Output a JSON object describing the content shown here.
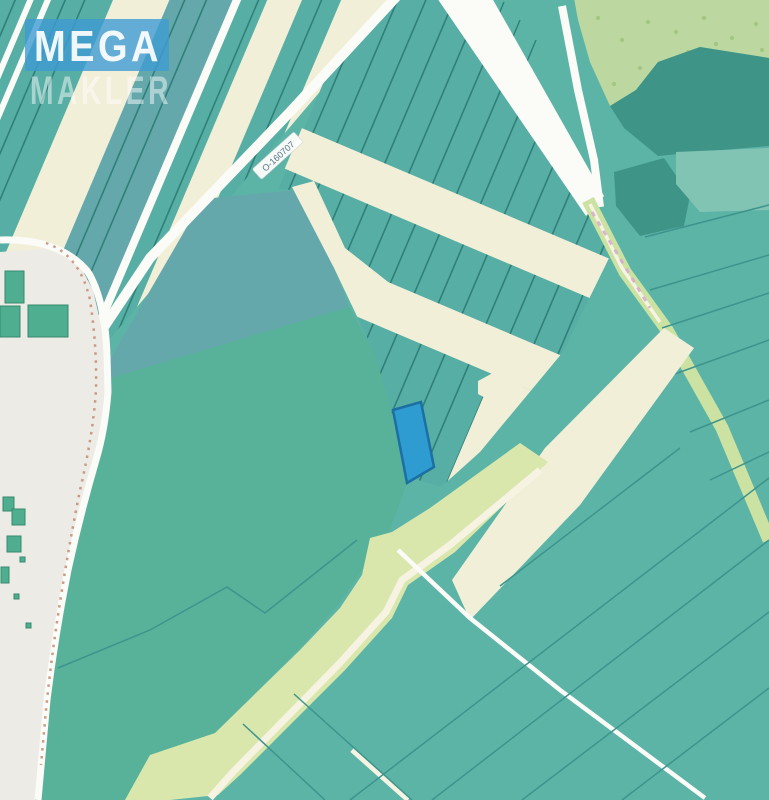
{
  "map": {
    "watermark": {
      "line1": "MEGA",
      "line2": "MAKLER"
    },
    "road_ref": "О-160707",
    "highlighted_parcel_color": "#2E9BD1"
  },
  "palette": {
    "base_teal": "#5CB4A7",
    "strip_teal": "#57AEA4",
    "strip_divider": "#2F8078",
    "field_divider": "#3D948C",
    "cream": "#F2EFD9",
    "blue_gray_field": "#64A8AC",
    "green_field": "#58B299",
    "forest": "#3F9488",
    "scrub": "#BCD8A0",
    "scrub_dot": "#A3C684",
    "light_field": "#82C4B4",
    "road_white": "#FBFBF7",
    "track_green": "#CBE2A2",
    "band_green": "#D9E7AC",
    "band_core": "#F6F3E2",
    "residential": "#EDEBE5",
    "building": "#4FAE90",
    "building_stroke": "#38896E",
    "footpath": "#C4907A",
    "pink_dash": "#D5A6CD",
    "highlight_fill": "#2E9BD1",
    "highlight_stroke": "#1B6FA3",
    "watermark_blue": "#3E9BD3",
    "watermark_text": "#FFFFFF",
    "label_text": "#5E7389",
    "label_bg": "#FEFEFC"
  }
}
